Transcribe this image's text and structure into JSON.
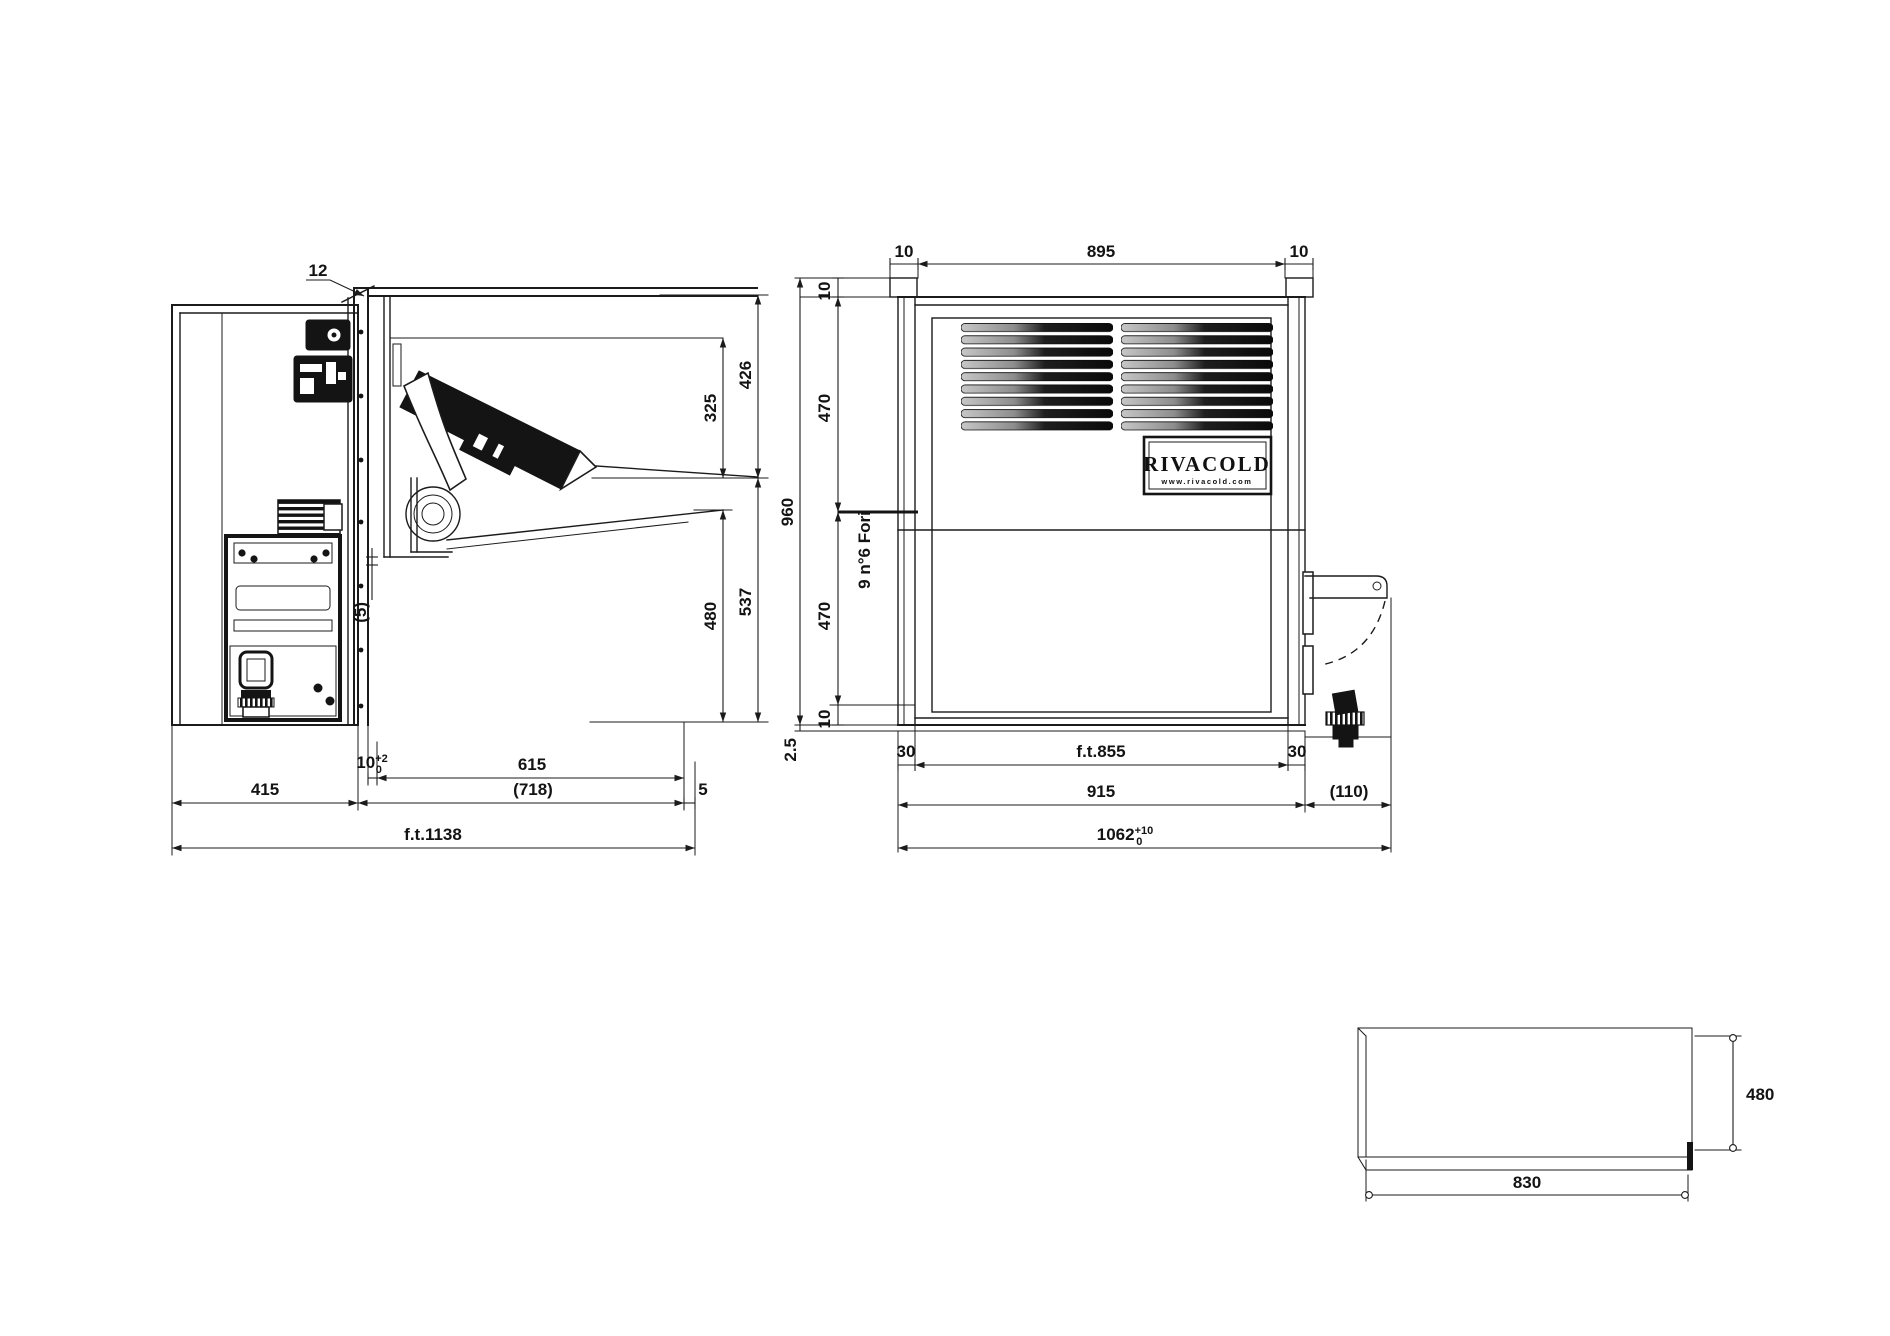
{
  "title": "Refrigeration monoblock unit dimensional drawing",
  "brand": {
    "logo_text": "RIVACOLD",
    "logo_website": "www.rivacold.com"
  },
  "side_view": {
    "dim_panel_thickness": "12",
    "dim_evaporator_drop": "325",
    "dim_ceiling_section": "426",
    "dim_lower_clearance": "480",
    "dim_lower_overall": "537",
    "dim_flap_gap": "(5)",
    "dim_recess_main": "10",
    "dim_recess_tol_plus": "+2",
    "dim_recess_tol_minus": "0",
    "dim_room_opening": "615",
    "dim_external_depth": "415",
    "dim_internal_depth": "(718)",
    "dim_front_lip": "5",
    "dim_overall_depth": "f.t.1138"
  },
  "front_view": {
    "dim_top_left_flange": "10",
    "dim_top_width": "895",
    "dim_top_right_flange": "10",
    "dim_cap_height": "10",
    "dim_overall_height": "960",
    "dim_upper_half": "470",
    "dim_lower_half": "470",
    "dim_bottom_flange": "10",
    "dim_base_gap": "2.5",
    "note_fixing_holes": "9 n°6 Fori",
    "dim_left_flange": "30",
    "dim_opening_width": "f.t.855",
    "dim_right_flange": "30",
    "dim_body_width": "915",
    "dim_valve_extension": "(110)",
    "dim_total_width_main": "1062",
    "dim_total_width_tol_plus": "+10",
    "dim_total_width_tol_minus": "0"
  },
  "plan_view": {
    "dim_depth": "480",
    "dim_width": "830"
  }
}
